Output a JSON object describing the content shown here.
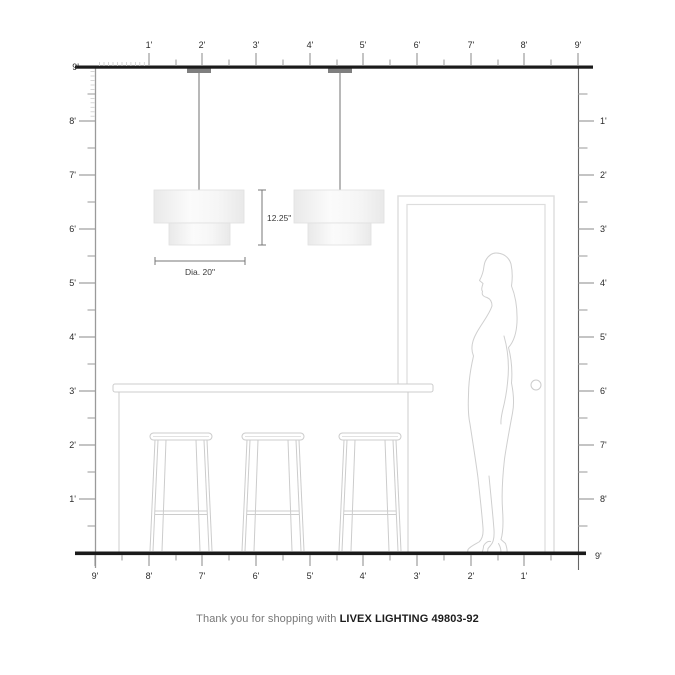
{
  "footer": {
    "prefix": "Thank you for shopping with ",
    "brand": "LIVEX LIGHTING 49803-92"
  },
  "annotations": {
    "shade_height": "12.25\"",
    "shade_diameter": "Dia. 20\""
  },
  "rulers": {
    "unit": "feet",
    "top": [
      "1'",
      "2'",
      "3'",
      "4'",
      "5'",
      "6'",
      "7'",
      "8'",
      "9'"
    ],
    "left": [
      "9'",
      "8'",
      "7'",
      "6'",
      "5'",
      "4'",
      "3'",
      "2'",
      "1'"
    ],
    "right": [
      "1'",
      "2'",
      "3'",
      "4'",
      "5'",
      "6'",
      "7'",
      "8'"
    ],
    "right_floor": "9'",
    "bottom": [
      "9'",
      "8'",
      "7'",
      "6'",
      "5'",
      "4'",
      "3'",
      "2'",
      "1'"
    ]
  },
  "colors": {
    "structure_line": "#1a1a1a",
    "ruler_line": "#9a9a9a",
    "tick_label": "#2b2b2b",
    "canopy": "#7f7f7f",
    "furniture_outline": "#cccccc",
    "silhouette_outline": "#cfcfcf",
    "dimension_line": "#777777"
  }
}
